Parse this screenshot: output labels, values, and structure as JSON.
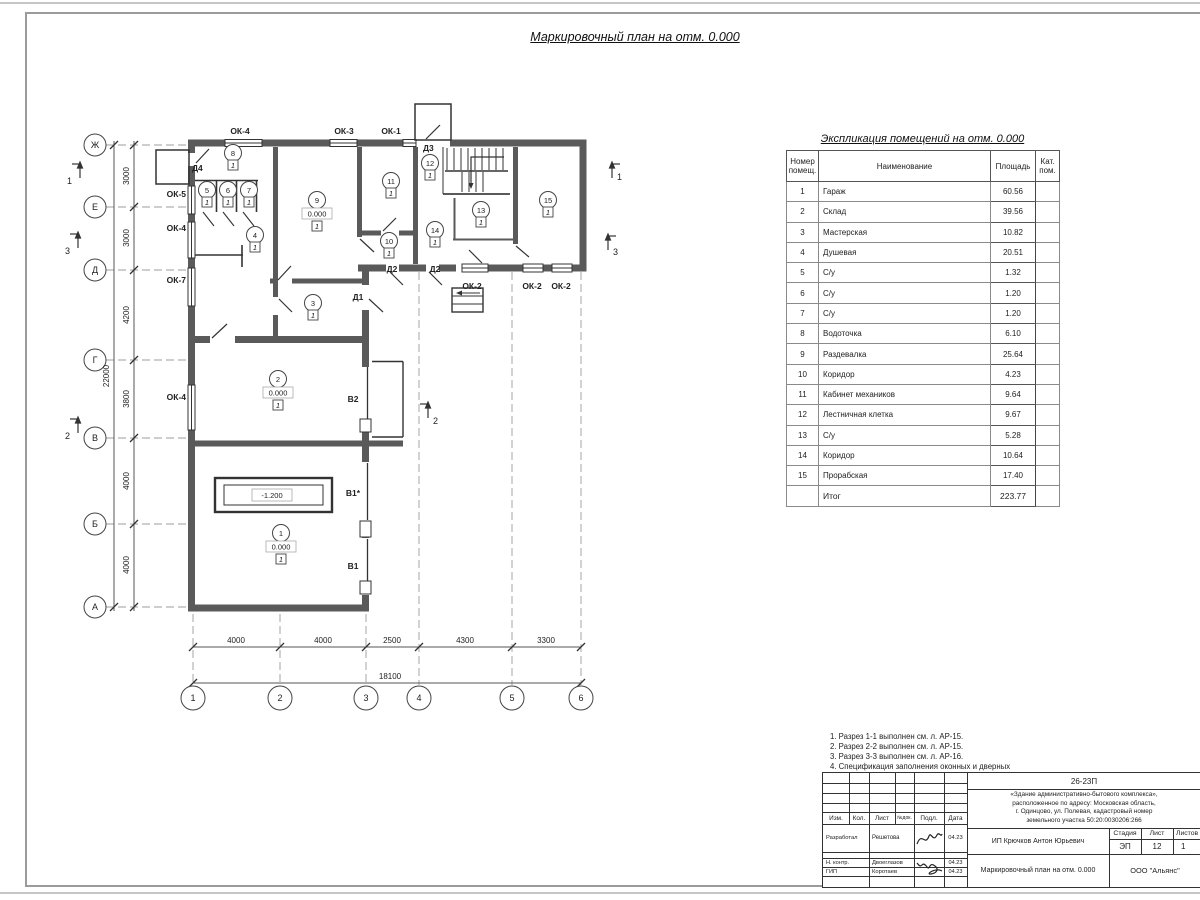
{
  "page": {
    "plan_title": "Маркировочный план на отм. 0.000",
    "table_title": "Экспликация помещений на отм. 0.000"
  },
  "plan": {
    "row_axes": [
      "Ж",
      "Е",
      "Д",
      "Г",
      "В",
      "Б",
      "А"
    ],
    "col_axes": [
      "1",
      "2",
      "3",
      "4",
      "5",
      "6"
    ],
    "dims_left": [
      "3000",
      "3000",
      "4200",
      "3800",
      "4000",
      "4000"
    ],
    "dim_left_total": "22000",
    "dims_bottom": [
      "4000",
      "4000",
      "2500",
      "4300",
      "3300"
    ],
    "dim_bottom_total": "18100",
    "rooms": [
      "1",
      "2",
      "3",
      "4",
      "5",
      "6",
      "7",
      "8",
      "9",
      "10",
      "11",
      "12",
      "13",
      "14",
      "15"
    ],
    "floor_mark": "1",
    "elev_zero": "0.000",
    "pit_elev": "-1.200",
    "sections": [
      "1",
      "3",
      "2"
    ],
    "windows_top": [
      "ОК-4",
      "ОК-3",
      "ОК-1"
    ],
    "windows_left": [
      "ОК-5",
      "ОК-4",
      "ОК-7",
      "ОК-4"
    ],
    "windows_bottom": [
      "ОК-2",
      "ОК-2",
      "ОК-2"
    ],
    "doors": [
      "Д4",
      "Д3",
      "Д2",
      "Д2",
      "Д1"
    ],
    "gates": [
      "В2",
      "В1*",
      "В1"
    ]
  },
  "table": {
    "headers": {
      "num_l1": "Номер",
      "num_l2": "помещ.",
      "name": "Наименование",
      "area": "Площадь",
      "cat_l1": "Кат.",
      "cat_l2": "пом."
    },
    "rows": [
      {
        "n": "1",
        "name": "Гараж",
        "area": "60.56"
      },
      {
        "n": "2",
        "name": "Склад",
        "area": "39.56"
      },
      {
        "n": "3",
        "name": "Мастерская",
        "area": "10.82"
      },
      {
        "n": "4",
        "name": "Душевая",
        "area": "20.51"
      },
      {
        "n": "5",
        "name": "С/у",
        "area": "1.32"
      },
      {
        "n": "6",
        "name": "С/у",
        "area": "1.20"
      },
      {
        "n": "7",
        "name": "С/у",
        "area": "1.20"
      },
      {
        "n": "8",
        "name": "Водоточка",
        "area": "6.10"
      },
      {
        "n": "9",
        "name": "Раздевалка",
        "area": "25.64"
      },
      {
        "n": "10",
        "name": "Коридор",
        "area": "4.23"
      },
      {
        "n": "11",
        "name": "Кабинет механиков",
        "area": "9.64"
      },
      {
        "n": "12",
        "name": "Лестничная клетка",
        "area": "9.67"
      },
      {
        "n": "13",
        "name": "С/у",
        "area": "5.28"
      },
      {
        "n": "14",
        "name": "Коридор",
        "area": "10.64"
      },
      {
        "n": "15",
        "name": "Прорабская",
        "area": "17.40"
      }
    ],
    "total_label": "Итог",
    "total_area": "223.77"
  },
  "notes": {
    "lines": [
      {
        "text": "1. Разрез 1-1 выполнен см. л. АР-15."
      },
      {
        "text": "2. Разрез 2-2 выполнен см. л. АР-15."
      },
      {
        "text": "3. Разрез 3-3 выполнен см. л. АР-16."
      },
      {
        "text": "4. Спецификация заполнения оконных и дверных"
      },
      {
        "text": "    проемов выполнена см. л. АР-17."
      },
      {
        "text": "5. Экспликация полов выполнена см. л. АР-17."
      }
    ]
  },
  "titleblock": {
    "code": "26-23П",
    "desc": [
      "«Здание административно-бытового комплекса»,",
      "расположенное по адресу: Московская область,",
      "г. Одинцово, ул. Полевая, кадастровый номер",
      "земельного участка 50:20:0030206:266"
    ],
    "hdr": {
      "izm": "Изм.",
      "kol": "Кол.",
      "list": "Лист",
      "ndoc": "№док.",
      "podp": "Подл.",
      "date": "Дата"
    },
    "rows": [
      {
        "role": "Разработал",
        "name": "Решетова",
        "date": "04.23"
      },
      {
        "role": "Н. контр.",
        "name": "Двоеглазов",
        "date": "04.23"
      },
      {
        "role": "ГИП",
        "name": "Коротаев",
        "date": "04.23"
      }
    ],
    "client": "ИП Крючков Антон Юрьевич",
    "stage_label": "Стадия",
    "sheet_label": "Лист",
    "sheets_label": "Листов",
    "stage": "ЭП",
    "sheet_num": "12",
    "sheets_num": "1",
    "doc_title": "Маркировочный план на отм. 0.000",
    "company": "ООО \"Альянс\""
  }
}
